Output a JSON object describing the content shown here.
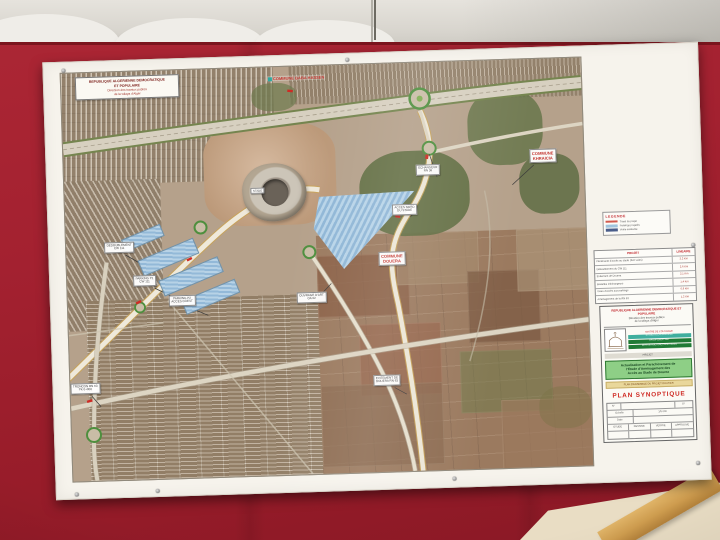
{
  "colors": {
    "wall_red": "#9e2130",
    "accent_red": "#c0262c",
    "project_green": "#1f7a35",
    "study_box_green": "#8ecf86",
    "parking_blue": "#9fc3dd",
    "road_casing_orange": "#c9a356"
  },
  "poster": {
    "map": {
      "header": {
        "l1": "REPUBLIQUE ALGERIENNE DEMOCRATIQUE",
        "l2": "ET POPULAIRE",
        "l3": "Direction des travaux publics",
        "l4": "de la wilaya d'Alger"
      },
      "communes": {
        "baba": "COMMUNE BABA HASSEN",
        "khraicia": {
          "l1": "COMMUNE",
          "l2": "KHRAICIA"
        },
        "douera": {
          "l1": "COMMUNE",
          "l2": "DOUERA"
        }
      },
      "stade_label": "STADE",
      "callouts": [
        {
          "l1": "ECHANGEUR",
          "l2": "RN 36"
        },
        {
          "l1": "ACCES NORD",
          "l2": "DU STADE"
        },
        {
          "l1": "DEDOUBLEMENT",
          "l2": "CW 111"
        },
        {
          "l1": "PARKING P1",
          "l2": "CW 111"
        },
        {
          "l1": "PARKING P2",
          "l2": "ACCES OUEST"
        },
        {
          "l1": "OUVRAGE D'ART",
          "l2": "OA 02"
        },
        {
          "l1": "EVITEMENT DE",
          "l2": "DOUERA RN 63"
        },
        {
          "l1": "TRONCON RN 63",
          "l2": "PK 0+000"
        }
      ]
    },
    "panel": {
      "legend": {
        "title": "LEGENDE",
        "items": [
          {
            "label": "Tracé du projet",
            "color": "#d25a4e"
          },
          {
            "label": "Parkings projetés",
            "color": "#9fc3dd"
          },
          {
            "label": "Voirie existante",
            "color": "#4a5d8a"
          }
        ]
      },
      "table": {
        "col1": "PROJET",
        "col2": "LINEAIRE",
        "rows": [
          {
            "label": "Pénétrante d'accès au stade (2x2 voies)",
            "value": "3,2 Km"
          },
          {
            "label": "Dédoublement du CW 111",
            "value": "2,6 Km"
          },
          {
            "label": "Evitement de Douera",
            "value": "2,1 Km"
          },
          {
            "label": "Bretelles d'échangeurs",
            "value": "1,4 Km"
          },
          {
            "label": "Voies d'accès aux parkings",
            "value": "0,9 Km"
          },
          {
            "label": "Aménagement de la RN 63",
            "value": "1,2 Km"
          }
        ]
      },
      "title_block": {
        "republic": "REPUBLIQUE ALGERIENNE DEMOCRATIQUE ET POPULAIRE",
        "dir1": "Direction des travaux publics",
        "dir2": "de la wilaya d'Alger",
        "owner": "MAITRE DE L'OUVRAGE",
        "bar_teal": "ETUDES & ENGINEERING",
        "bar_green1": "GROUPEMENT BET",
        "bar_green2": "INFRASTRUCTURES ROUTIERES",
        "project_label": "PROJET",
        "study_l1": "Actualisation et Parachèvement de",
        "study_l2": "l'Etude d'Aménagement des",
        "study_l3": "Accès au Stade de Douera",
        "strip": "PLAN D'ENSEMBLE DU PROJET ROUTIER",
        "plan_title": "PLAN SYNOPTIQUE",
        "form": {
          "number_label": "N°",
          "sheet_number": "07",
          "scale_label": "Echelle",
          "scale_value": "1/5 000",
          "date_label": "Date",
          "date_value": "",
          "sig_headers": [
            "ETUDE",
            "DESSINE",
            "VERIFIE",
            "APPROUVE"
          ]
        }
      }
    }
  }
}
